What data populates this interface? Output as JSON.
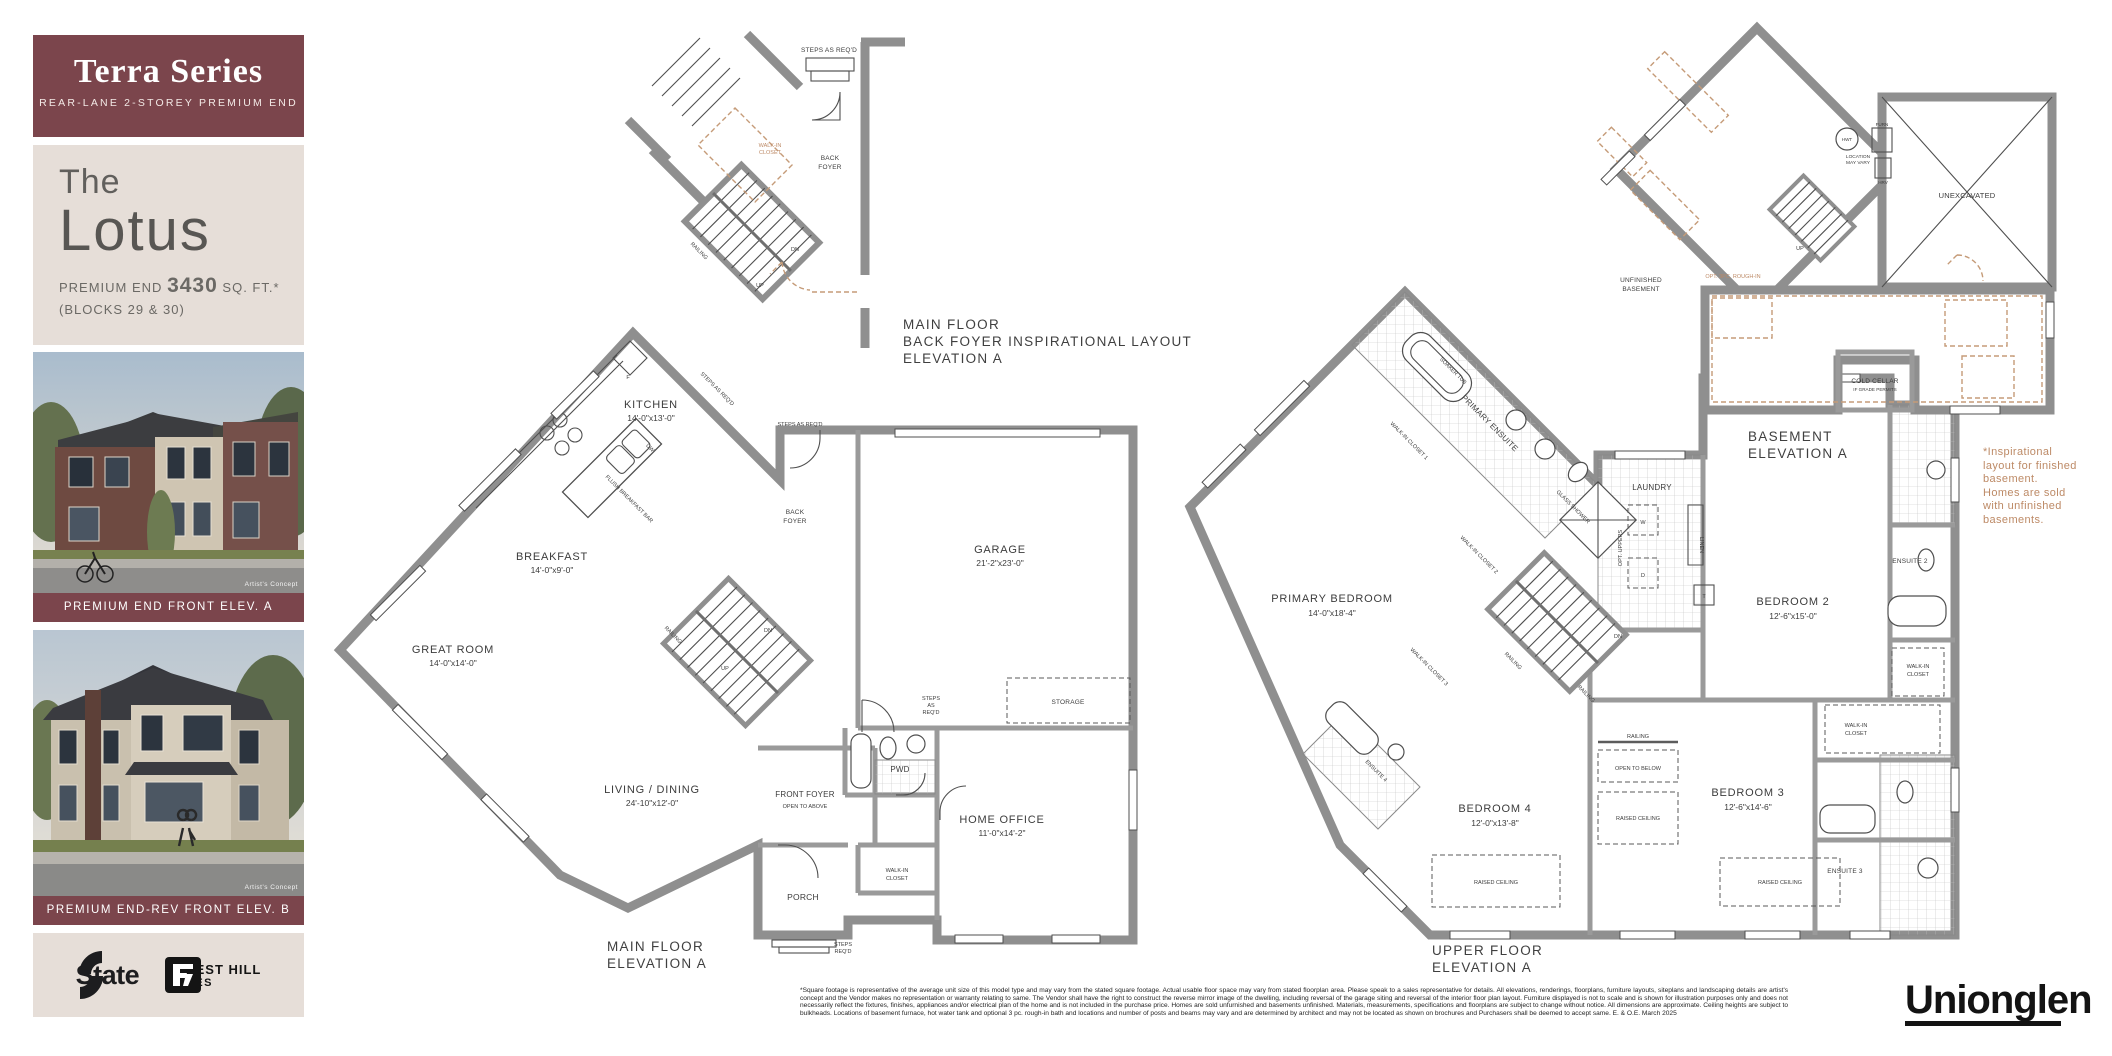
{
  "colors": {
    "maroon": "#7b454c",
    "beige": "#e6ded8",
    "tan": "#bd8a66",
    "wall_gray": "#8f8f8f",
    "ink": "#3c3c3c"
  },
  "sidebar": {
    "series_title": "Terra Series",
    "series_subtitle": "REAR-LANE 2-STOREY PREMIUM END",
    "model_prefix": "The",
    "model_name": "Lotus",
    "size_prefix": "PREMIUM END",
    "size_value": "3430",
    "size_suffix": "SQ. FT.*",
    "blocks_line": "(BLOCKS 29 & 30)",
    "elevations": [
      {
        "caption": "PREMIUM END FRONT ELEV. A",
        "credit": "Artist's Concept"
      },
      {
        "caption": "PREMIUM END-REV FRONT ELEV. B",
        "credit": "Artist's Concept"
      }
    ],
    "logos": {
      "state": "State",
      "fh1": "FOREST HILL",
      "fh2": "HOMES"
    }
  },
  "inset": {
    "caption1": "MAIN FLOOR",
    "caption2": "BACK FOYER INSPIRATIONAL LAYOUT",
    "caption3": "ELEVATION A",
    "steps": "STEPS AS REQ'D",
    "wic1": "WALK-IN",
    "wic2": "CLOSET",
    "back1": "BACK",
    "back2": "FOYER",
    "railing": "RAILING",
    "up": "UP",
    "dn": "DN"
  },
  "main": {
    "caption1": "MAIN FLOOR",
    "caption2": "ELEVATION A",
    "kitchen": "KITCHEN",
    "kitchen_d": "14'-0\"x13'-0\"",
    "breakfast": "BREAKFAST",
    "breakfast_d": "14'-0\"x9'-0\"",
    "great": "GREAT ROOM",
    "great_d": "14'-0\"x14'-0\"",
    "living": "LIVING / DINING",
    "living_d": "24'-10\"x12'-0\"",
    "garage": "GARAGE",
    "garage_d": "21'-2\"x23'-0\"",
    "office": "HOME OFFICE",
    "office_d": "11'-0\"x14'-2\"",
    "front_foyer": "FRONT FOYER",
    "open_above": "OPEN TO ABOVE",
    "pwd": "PWD",
    "porch": "PORCH",
    "back1": "BACK",
    "back2": "FOYER",
    "wic1": "WALK-IN",
    "wic2": "CLOSET",
    "storage": "STORAGE",
    "steps": "STEPS AS REQ'D",
    "steps_a": "STEPS",
    "steps_b": "AS",
    "steps_c": "REQ'D",
    "flush_bar": "FLUSH BREAKFAST BAR",
    "railing": "RAILING",
    "up": "UP",
    "dn": "DN",
    "f": "F",
    "dw": "DW"
  },
  "upper": {
    "caption1": "UPPER FLOOR",
    "caption2": "ELEVATION A",
    "primary": "PRIMARY BEDROOM",
    "primary_d": "14'-0\"x18'-4\"",
    "bed2": "BEDROOM 2",
    "bed2_d": "12'-6\"x15'-0\"",
    "bed3": "BEDROOM 3",
    "bed3_d": "12'-6\"x14'-6\"",
    "bed4": "BEDROOM 4",
    "bed4_d": "12'-0\"x13'-8\"",
    "p_ensuite": "PRIMARY ENSUITE",
    "soaker": "SOAKER TUB",
    "shower": "GLASS SHOWER",
    "wic1": "WALK-IN CLOSET 1",
    "wic2": "WALK-IN CLOSET 2",
    "wic3": "WALK-IN CLOSET 3",
    "laundry": "LAUNDRY",
    "linen": "LINEN",
    "opt_uppers": "OPT. UPPERS",
    "w": "W",
    "d": "D",
    "t": "T",
    "ensuite2": "ENSUITE 2",
    "ensuite3": "ENSUITE 3",
    "ensuite4": "ENSUITE 4",
    "wic_a": "WALK-IN",
    "wic_b": "CLOSET",
    "railing": "RAILING",
    "open_below": "OPEN TO BELOW",
    "raised": "RAISED CEILING",
    "dn": "DN"
  },
  "basement": {
    "caption1": "BASEMENT",
    "caption2": "ELEVATION A",
    "unex": "UNEXCAVATED",
    "unf1": "UNFINISHED",
    "unf2": "BASEMENT",
    "cold1": "COLD CELLAR",
    "cold2": "IF GRADE PERMITS",
    "hwt": "HWT",
    "furn": "FURN",
    "hrv": "HRV",
    "loc1": "LOCATION",
    "loc2": "MAY VARY",
    "rough": "OPT. 3PC. ROUGH-IN",
    "up": "UP",
    "note1": "*Inspirational",
    "note2": "layout for finished",
    "note3": "basement.",
    "note4": "Homes are sold",
    "note5": "with unfinished",
    "note6": "basements."
  },
  "footer": {
    "disclaimer": "*Square footage is representative of the average unit size of this model type and may vary from the stated square footage. Actual usable floor space may vary from stated floorplan area. Please speak to a sales representative for details. All elevations, renderings, floorplans, furniture layouts, siteplans and landscaping details are artist's concept and the Vendor makes no representation or warranty relating to same. The Vendor shall have the right to construct the reverse mirror image of the dwelling, including reversal of the garage siting and reversal of the interior floor plan layout. Furniture displayed is not to scale and is shown for illustration purposes only and does not necessarily reflect the fixtures, finishes, appliances and/or electrical plan of the home and is not included in the purchase price. Homes are sold unfurnished and basements unfinished. Materials, measurements, specifications and floorplans are subject to change without notice. All dimensions are approximate. Ceiling heights are subject to bulkheads. Locations of basement furnace, hot water tank and optional 3 pc. rough-in bath and locations and number of posts and beams may vary and are determined by architect and may not be located as shown on brochures and Purchasers shall be deemed to accept same. E. & O.E. March 2025",
    "brand": "Unionglen"
  }
}
